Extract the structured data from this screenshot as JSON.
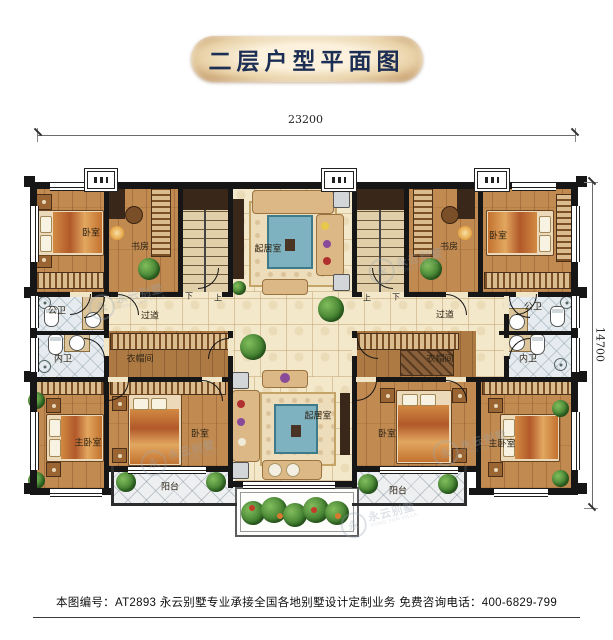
{
  "title": "二层户型平面图",
  "dimensions": {
    "width_label": "23200",
    "height_label": "14700"
  },
  "rooms": [
    {
      "id": "bedroom-top-left",
      "label": "卧室"
    },
    {
      "id": "study-left",
      "label": "书房"
    },
    {
      "id": "living-top",
      "label": "起居室"
    },
    {
      "id": "study-right",
      "label": "书房"
    },
    {
      "id": "bedroom-top-right",
      "label": "卧室"
    },
    {
      "id": "bath-public-left",
      "label": "公卫"
    },
    {
      "id": "hall-left",
      "label": "过道"
    },
    {
      "id": "hall-right",
      "label": "过道"
    },
    {
      "id": "bath-public-right",
      "label": "公卫"
    },
    {
      "id": "bath-private-left",
      "label": "内卫"
    },
    {
      "id": "closet-left",
      "label": "衣帽间"
    },
    {
      "id": "closet-right",
      "label": "衣帽间"
    },
    {
      "id": "bath-private-right",
      "label": "内卫"
    },
    {
      "id": "master-bedroom-left",
      "label": "主卧室"
    },
    {
      "id": "bedroom-bottom-left",
      "label": "卧室"
    },
    {
      "id": "living-bottom",
      "label": "起居室"
    },
    {
      "id": "bedroom-bottom-right",
      "label": "卧室"
    },
    {
      "id": "master-bedroom-right",
      "label": "主卧室"
    },
    {
      "id": "balcony-left",
      "label": "阳台"
    },
    {
      "id": "balcony-right",
      "label": "阳台"
    }
  ],
  "stairs": {
    "left": {
      "down": "下",
      "up": "上"
    },
    "right": {
      "up": "上",
      "down": "下"
    }
  },
  "watermark": {
    "initial": "永",
    "brand": "永云别墅",
    "sub": "YONG YUN VILLA"
  },
  "footer": {
    "text": "本图编号：AT2893  永云别墅专业承接全国各地别墅设计定制业务  免费咨询电话：400-6829-799"
  },
  "colors": {
    "wall": "#161616",
    "wood": "#c18a51",
    "tile": "#f4e8cb",
    "bath": "#e5ebee",
    "title_text": "#1d2e55"
  }
}
